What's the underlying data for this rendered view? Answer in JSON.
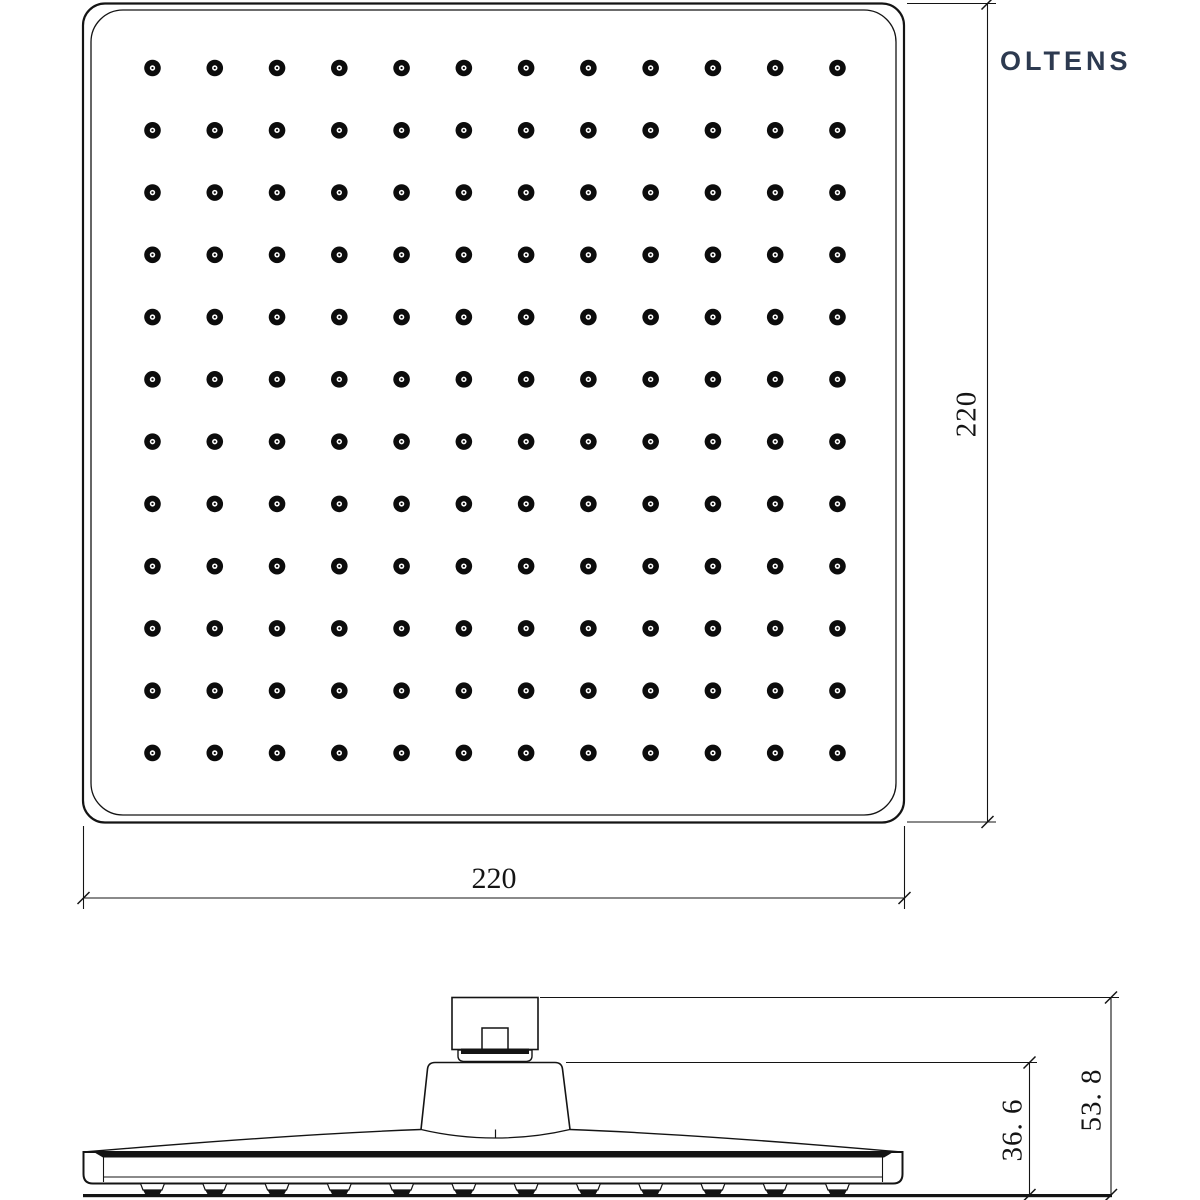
{
  "brand": {
    "logo_text": "OLTENS",
    "logo_color": "#2d3a50"
  },
  "drawing": {
    "line_color": "#141414",
    "views": {
      "top": {
        "name": "top-view-square-shower-head",
        "nozzle_grid": {
          "rows": 12,
          "cols": 12
        },
        "width_dim": "220",
        "height_dim": "220"
      },
      "side": {
        "name": "side-view-profile",
        "nozzle_count": 12,
        "head_height_dim": "36. 6",
        "overall_height_dim": "53. 8"
      }
    }
  }
}
